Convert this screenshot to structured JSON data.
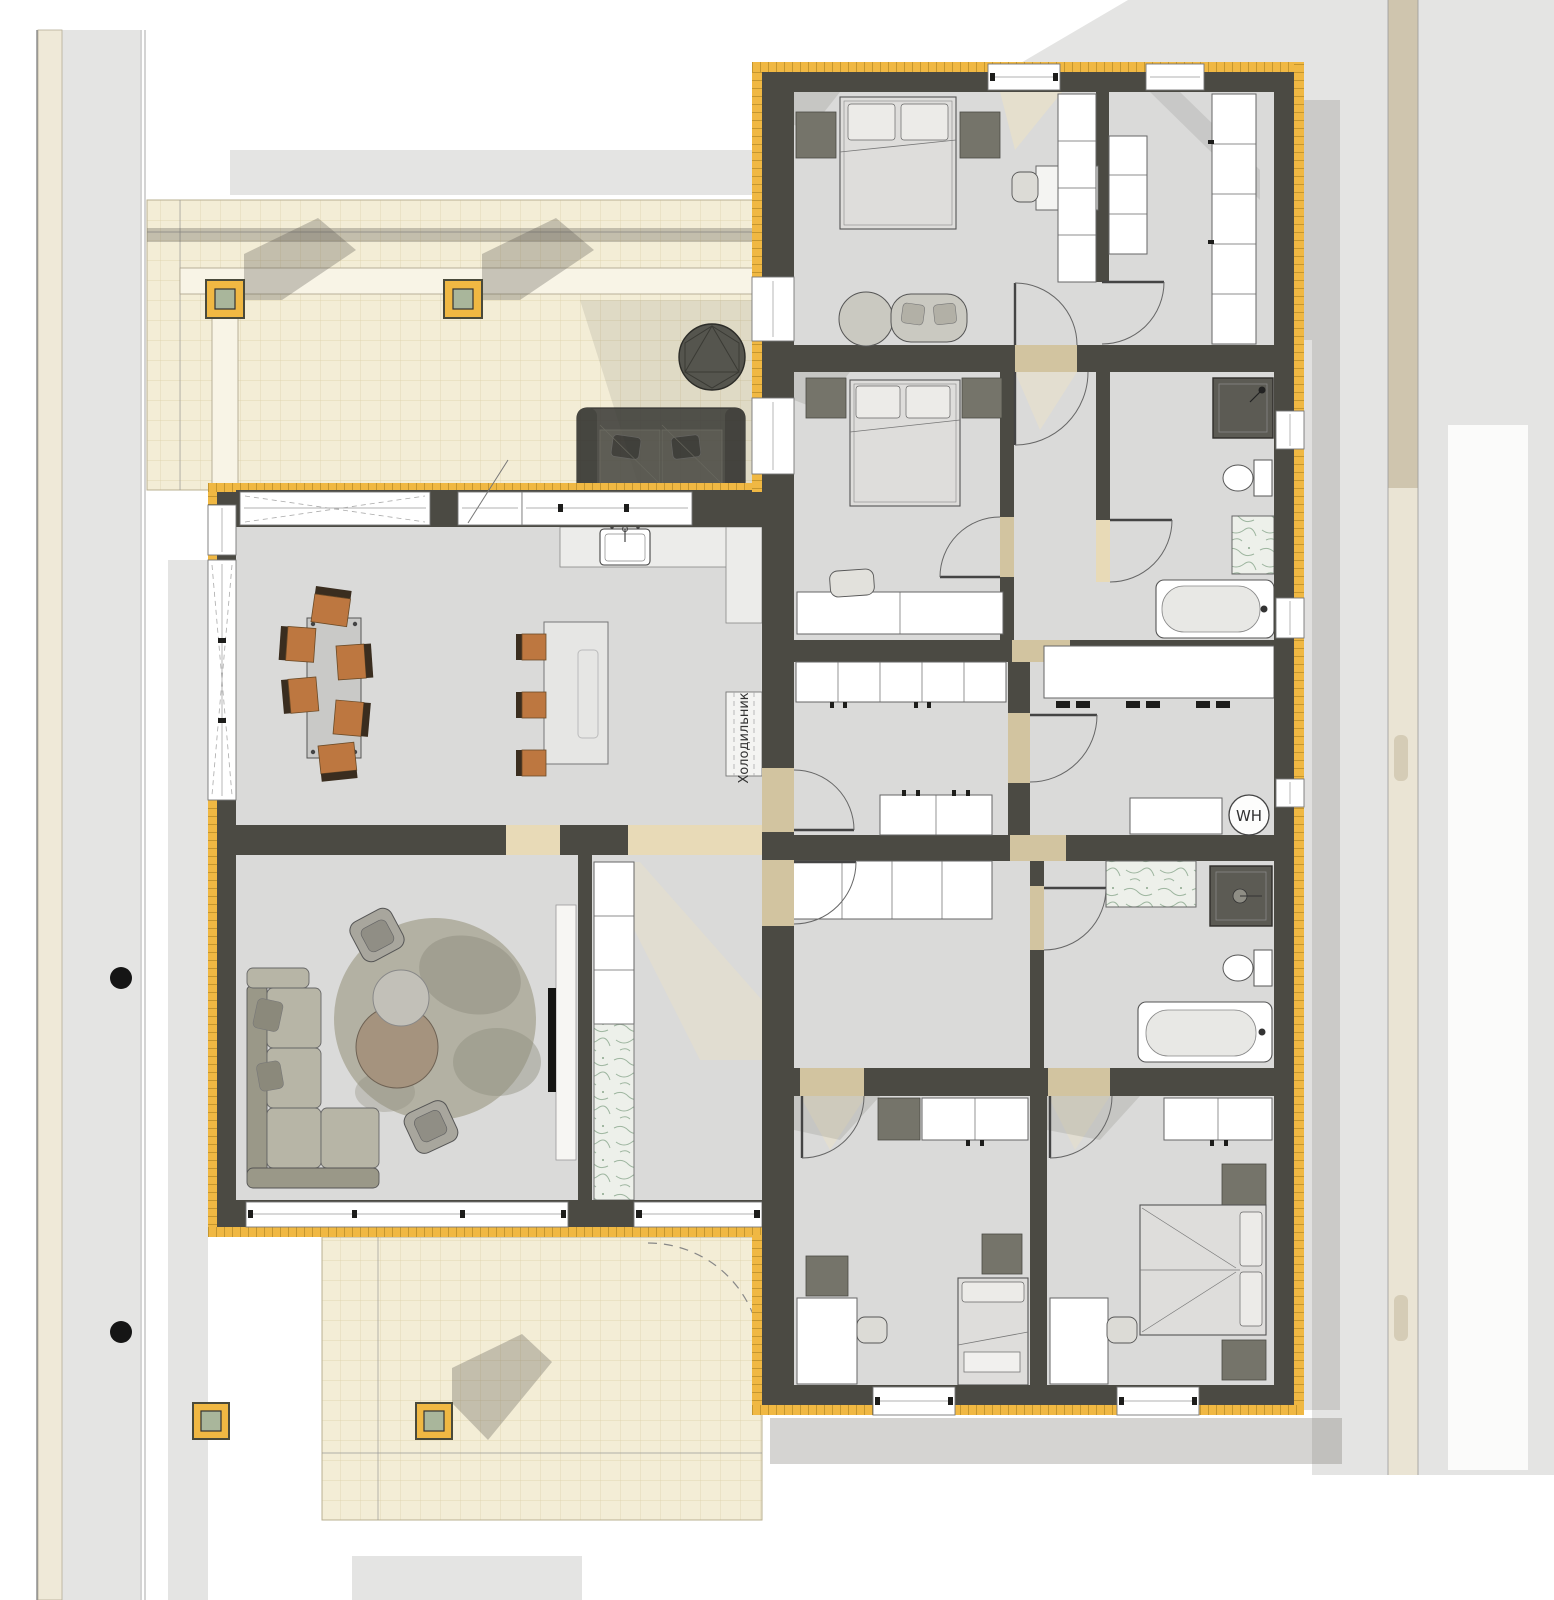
{
  "labels": {
    "refrigerator": "Холодильник",
    "water_heater": "WH"
  },
  "colors": {
    "wall": "#4b4a43",
    "hatch": "#f0b843",
    "hatch_line": "#9a7418",
    "floor": "#dadad9",
    "terrace": "#f3edd6",
    "tile_line": "#dccfa6",
    "site": "#e4e4e3",
    "path_tan": "#cfc5ae",
    "path_cream": "#eae4d4",
    "boundary_beige": "#efe9d8",
    "cab_stroke": "#666666",
    "dark_furn": "#75746a",
    "accent": "#bd7740",
    "accent_dark": "#3a2d1f",
    "sofa": "#b7b5a6",
    "sofa_dark": "#9a9888",
    "rug": "#b3b1a3",
    "rug_shadow": "#8f8d7f",
    "marble_bg": "#edf0ea",
    "marble_vein": "#8aa68c",
    "outdoor": "#3d3d39",
    "post_core": "#a9b69b",
    "threshold": "#ead9b0",
    "sun": "#efe3c2",
    "shadow": "#56544b",
    "shower": "#5c5b54",
    "table_gray": "#c9c9c7",
    "island": "#e6e6e4",
    "counter": "#ececea",
    "ink": "#333333"
  },
  "rooms": [
    "terrace-north",
    "kitchen-dining",
    "living-room",
    "entry-hall",
    "corridor",
    "master-bedroom",
    "walk-in-closet",
    "bedroom-2",
    "bathroom-1",
    "utility-room",
    "bathroom-2",
    "bedroom-3",
    "bedroom-4",
    "terrace-south"
  ],
  "furniture": {
    "terrace_north": [
      "outdoor-sofa",
      "outdoor-round-table",
      "pergola-posts"
    ],
    "kitchen_dining": [
      "dining-table",
      "six-dining-chairs",
      "kitchen-counter",
      "sink",
      "island",
      "three-bar-stools",
      "refrigerator-niche"
    ],
    "living_room": [
      "l-shaped-sofa",
      "round-rug",
      "two-coffee-tables",
      "two-armchairs",
      "tv-wall",
      "marble-column"
    ],
    "master_bedroom": [
      "double-bed",
      "two-nightstands",
      "bench-sofa",
      "desk-with-chair",
      "shelving"
    ],
    "walk_in_closet": [
      "shelving-columns"
    ],
    "bedroom_2": [
      "double-bed",
      "two-nightstands",
      "desk-with-chair"
    ],
    "bathroom_1": [
      "shower",
      "toilet",
      "marble-vanity",
      "bathtub"
    ],
    "utility_room": [
      "counter",
      "washer-dryer",
      "water-heater"
    ],
    "bathroom_2": [
      "shower",
      "toilet",
      "marble-vanity",
      "bathtub"
    ],
    "bedroom_3": [
      "single-bed",
      "wardrobe",
      "desk-with-chair",
      "dresser"
    ],
    "bedroom_4": [
      "double-bed",
      "wardrobe",
      "two-nightstands",
      "desk-with-chair"
    ],
    "corridor": [
      "wardrobe-rows"
    ],
    "site": [
      "boundary-lines",
      "two-boundary-dots",
      "footpath",
      "four-pergola-posts"
    ]
  }
}
